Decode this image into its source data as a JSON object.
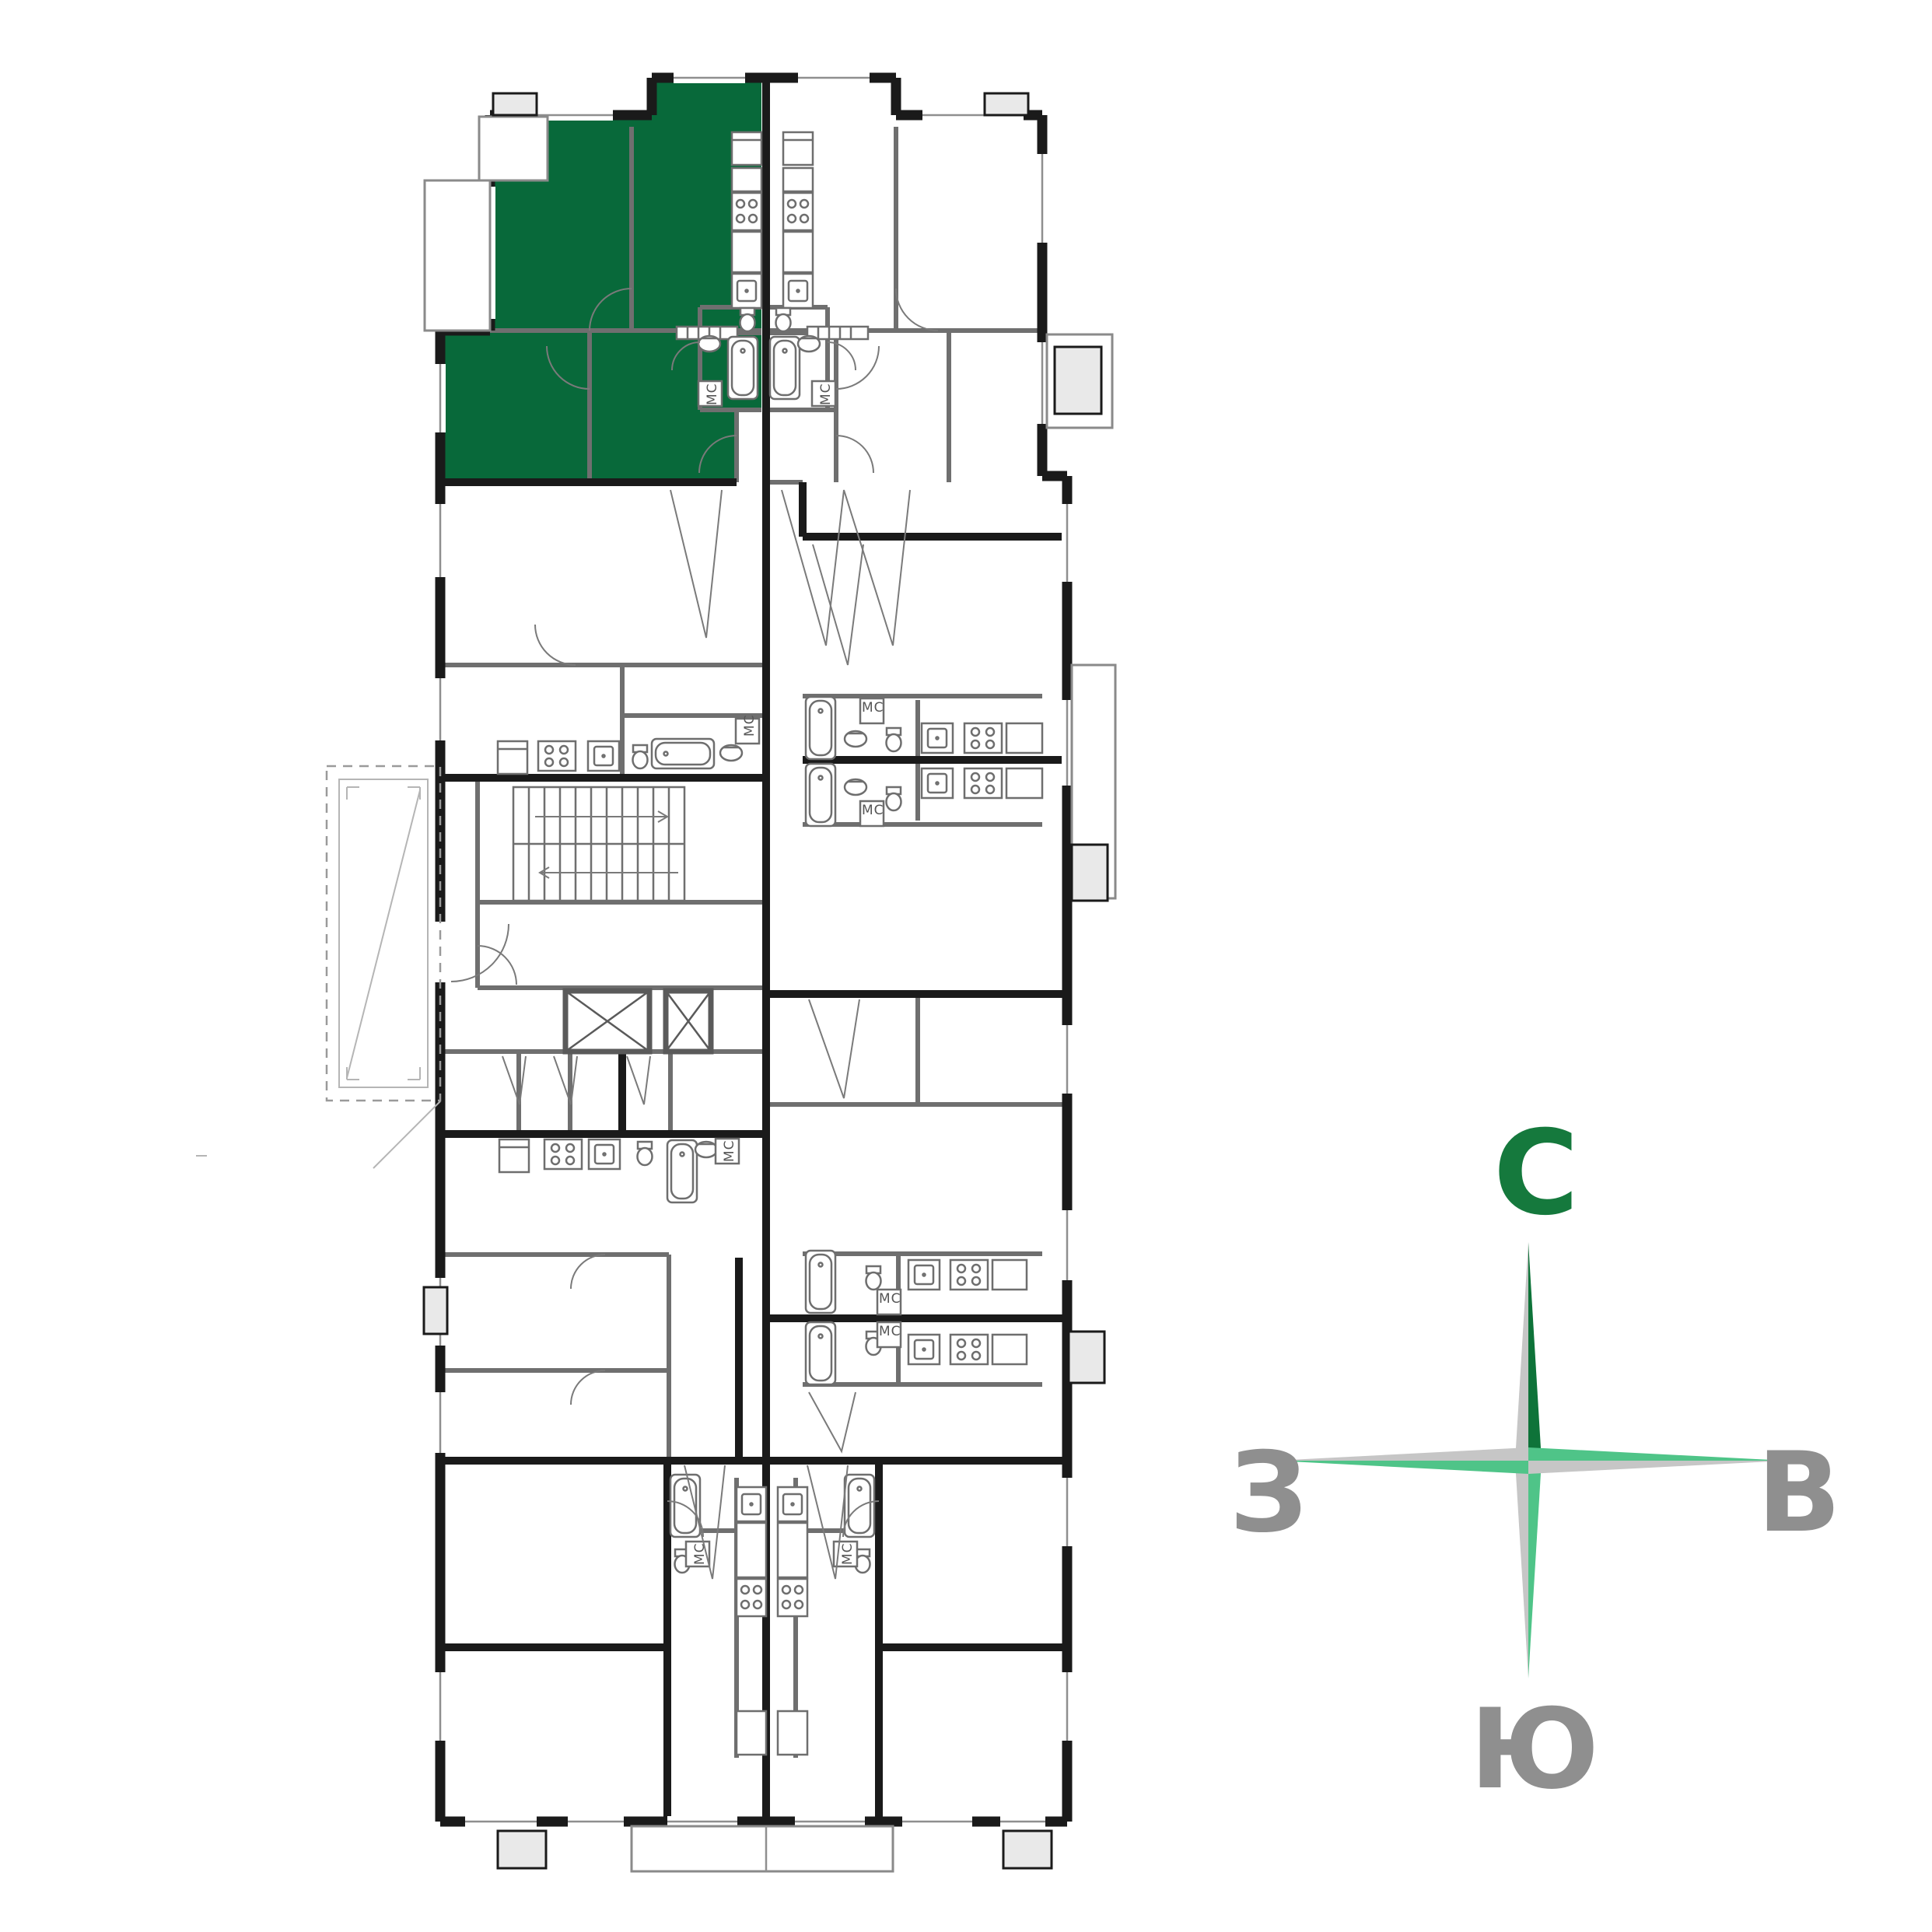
{
  "plan": {
    "washer_label": "МС",
    "highlighted_apartment": "top-left-two-room-apartment"
  },
  "colors": {
    "highlight": "#08693a",
    "wall": "#1a1a1a",
    "partition": "#6f6f6f",
    "fixture": "#6e6e6e",
    "compass_dark": "#0e7339",
    "compass_light": "#4fc488",
    "compass_gray": "#c6c6c6",
    "letter_north": "#15793d",
    "letter_gray": "#8f8f8f"
  },
  "compass": {
    "north_label": "С",
    "east_label": "В",
    "south_label": "Ю",
    "west_label": "З"
  }
}
